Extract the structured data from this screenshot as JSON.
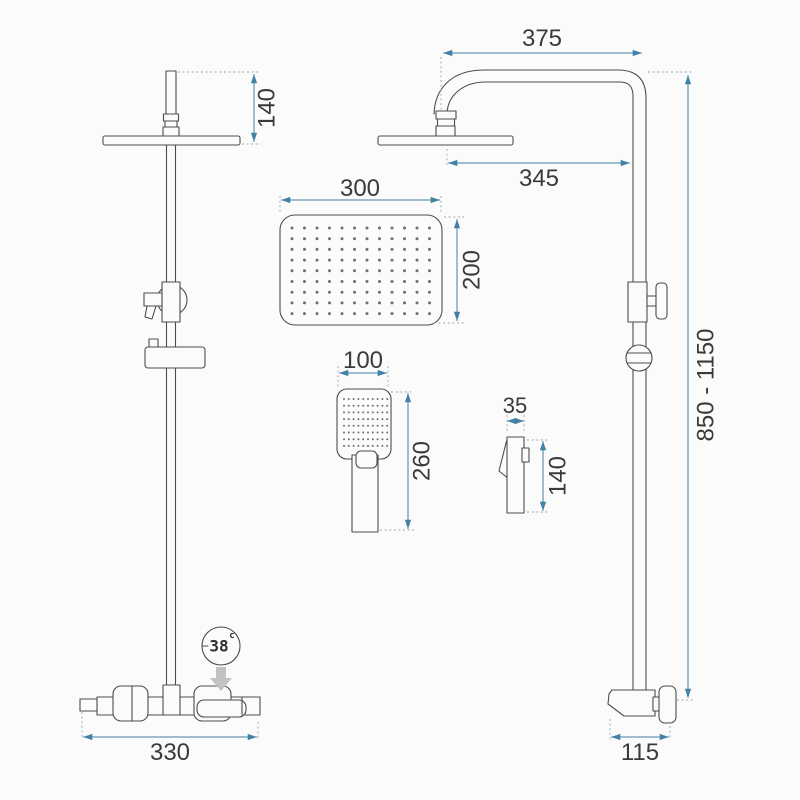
{
  "page": {
    "background": "#fbfbfb"
  },
  "drawing": {
    "colors": {
      "dimension": "#4181a5",
      "line": "#4d4d4d",
      "text": "#3a3a3a",
      "flow_arrow": "#c2c2c2"
    },
    "dims": {
      "head_drop": "140",
      "rain_head_width": "300",
      "rain_head_depth": "200",
      "hand_shower_width": "100",
      "hand_shower_length": "260",
      "hand_shower_depth": "35",
      "hand_shower_side_length": "140",
      "arm_reach": "375",
      "head_to_column": "345",
      "column_height_range": "850 - 1150",
      "mixer_width": "330",
      "wall_offset": "115"
    },
    "temp_badge": {
      "value": "38",
      "unit": "c"
    }
  }
}
